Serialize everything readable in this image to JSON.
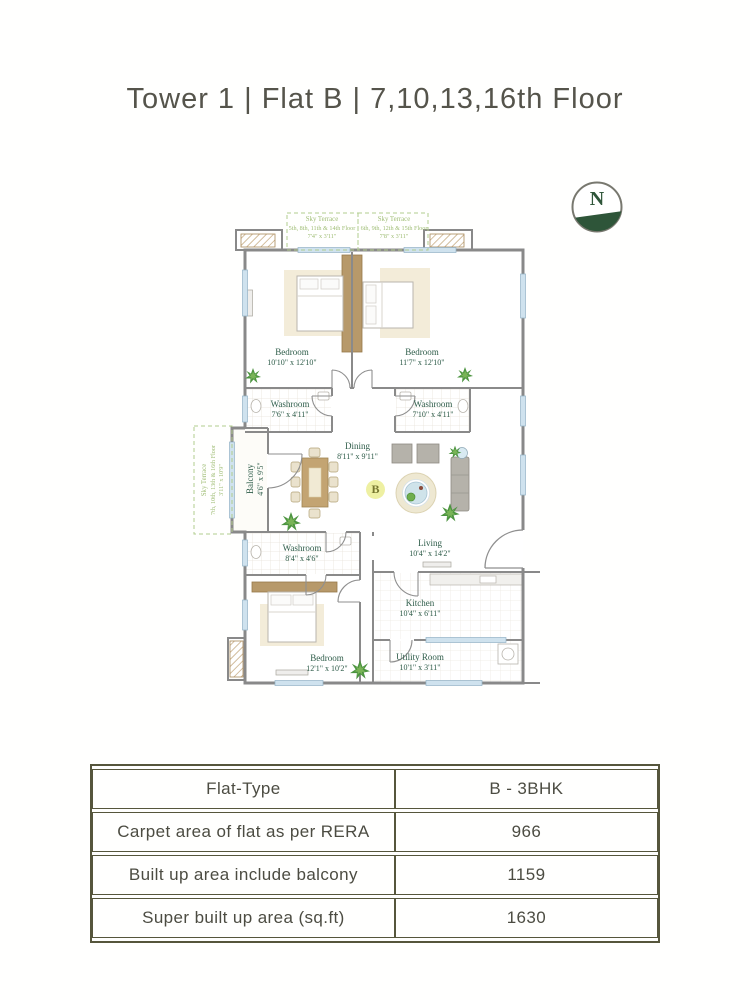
{
  "title": "Tower 1 | Flat B | 7,10,13,16th Floor",
  "compass": {
    "label": "N"
  },
  "badge": {
    "label": "B"
  },
  "plan": {
    "terraces": [
      {
        "name": "Sky Terrace",
        "floors": "5th, 8th, 11th & 14th Floor",
        "dims": "7'4\" x 3'11\""
      },
      {
        "name": "Sky Terrace",
        "floors": "6th, 9th, 12th & 15th Floor",
        "dims": "7'8\" x 3'11\""
      },
      {
        "name": "Sky Terrace",
        "floors": "7th, 10th, 13th & 16th Floor",
        "dims": "3'11\" x 10'9\""
      }
    ],
    "rooms": [
      {
        "name": "Bedroom",
        "dims": "10'10\" x 12'10\""
      },
      {
        "name": "Bedroom",
        "dims": "11'7\" x 12'10\""
      },
      {
        "name": "Washroom",
        "dims": "7'6\" x 4'11\""
      },
      {
        "name": "Washroom",
        "dims": "7'10\" x 4'11\""
      },
      {
        "name": "Balcony",
        "dims": "4'6\" x 9'5\""
      },
      {
        "name": "Dining",
        "dims": "8'11\" x 9'11\""
      },
      {
        "name": "Living",
        "dims": "10'4\" x 14'2\""
      },
      {
        "name": "Washroom",
        "dims": "8'4\" x 4'6\""
      },
      {
        "name": "Bedroom",
        "dims": "12'1\" x 10'2\""
      },
      {
        "name": "Kitchen",
        "dims": "10'4\" x 6'11\""
      },
      {
        "name": "Utility Room",
        "dims": "10'1\" x 3'11\""
      }
    ]
  },
  "table": {
    "rows": [
      {
        "label": "Flat-Type",
        "value": "B - 3BHK"
      },
      {
        "label": "Carpet area of flat as per RERA",
        "value": "966"
      },
      {
        "label": "Built up area include balcony",
        "value": "1159"
      },
      {
        "label": "Super built up area (sq.ft)",
        "value": "1630"
      }
    ]
  },
  "colors": {
    "room_label_green": "#2f5d4a",
    "terrace_green": "#9fbd75",
    "table_border_olive": "#56563c",
    "title_gray": "#55544b",
    "wall_gray": "#898989",
    "wood_tan": "#b7996a",
    "window_blue": "#cfe2ee",
    "badge_yellow": "#eef0a2",
    "compass_green": "#2e5539"
  }
}
